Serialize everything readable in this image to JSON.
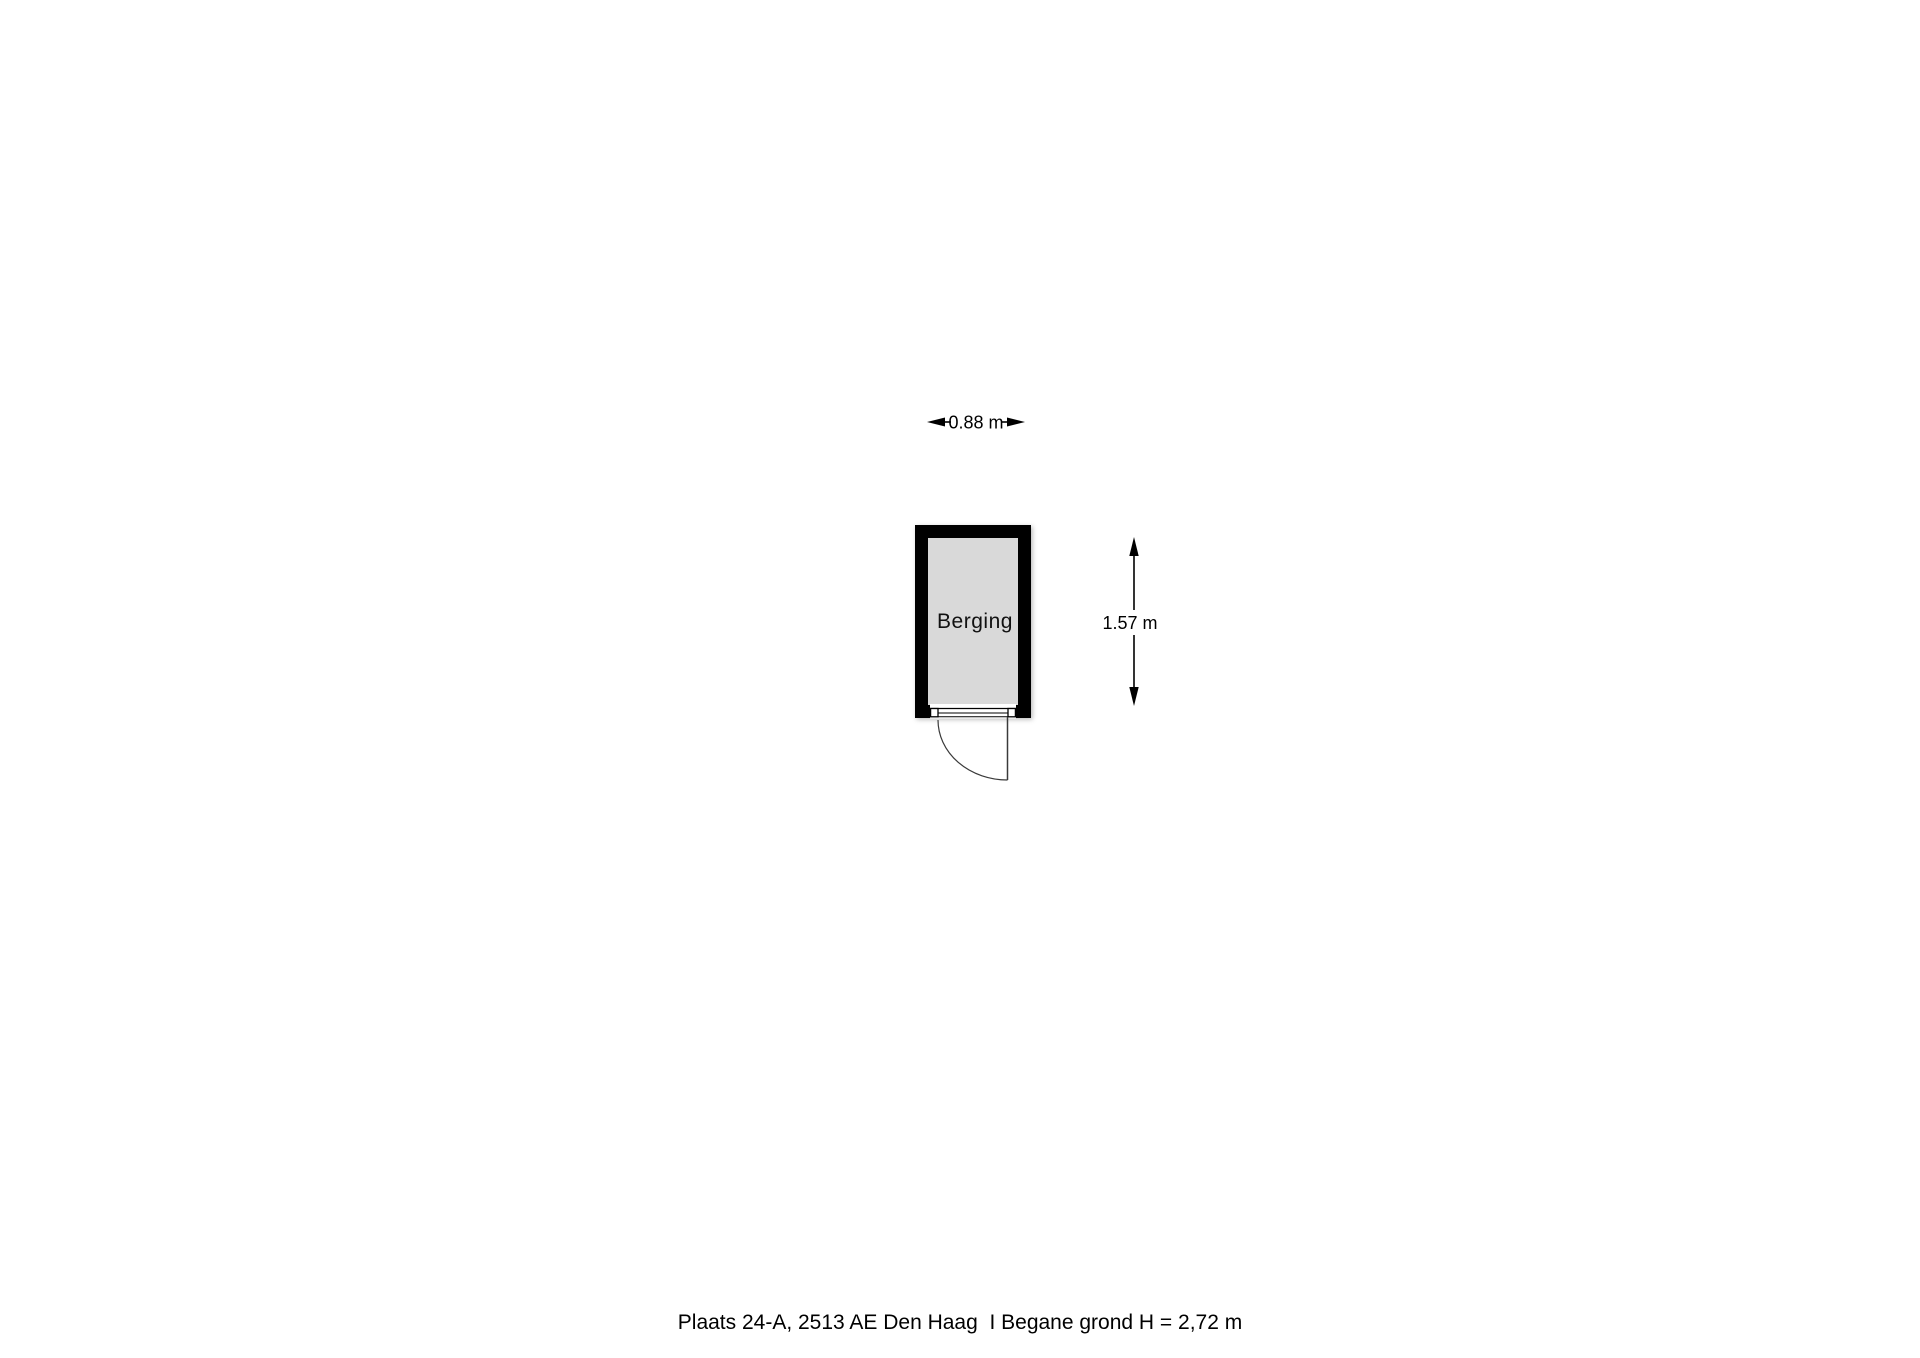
{
  "floorplan": {
    "room_label": "Berging",
    "width_dimension": "0.88 m",
    "height_dimension": "1.57 m",
    "colors": {
      "wall": "#000000",
      "room_fill": "#d9d9d9",
      "background": "#ffffff",
      "door_line": "#3a3a3a"
    }
  },
  "caption": {
    "text": "Plaats 24-A, 2513 AE Den Haag  I Begane grond H = 2,72 m"
  }
}
